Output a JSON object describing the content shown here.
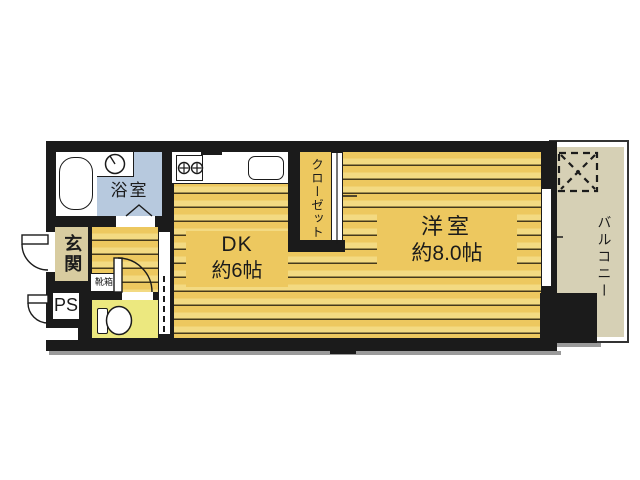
{
  "plan": {
    "bathroom": {
      "label": "浴室"
    },
    "entrance": {
      "label": "玄関"
    },
    "pipe_space": {
      "label": "PS"
    },
    "shoe_box": {
      "label": "靴箱"
    },
    "dk": {
      "label": "DK",
      "size": "約6帖"
    },
    "closet": {
      "label": "クローゼット"
    },
    "western_room": {
      "label": "洋室",
      "size": "約8.0帖"
    },
    "balcony": {
      "label": "バルコニー"
    }
  },
  "colors": {
    "wall_black": "#1b1b1b",
    "floor_yellow": "#edc85f",
    "floor_stripe": "#45391b",
    "bathroom_blue": "#b7c9de",
    "entrance_beige": "#d8cca0",
    "toilet_pale_yellow": "#ece87f",
    "balcony_cream": "#d6d0b5",
    "shadow_gray": "#9a9a9a",
    "line_ink": "#1b1b1b"
  },
  "icons": {
    "bathtub-icon": "rounded-rect outline",
    "washing-machine-icon": "circle with dial",
    "stove-icon": "box with two crossed burners",
    "sink-icon": "rounded-rect outline",
    "toilet-icon": "tank and bowl outline",
    "washer-place-icon": "dashed square with X",
    "door-swing-icon": "quarter-circle arc with leaf",
    "folding-door-icon": "inverted-V lines",
    "sliding-door-icon": "double white strip",
    "window-icon": "double-line strip with tick",
    "opening-dashed-icon": "dashed vertical line"
  }
}
